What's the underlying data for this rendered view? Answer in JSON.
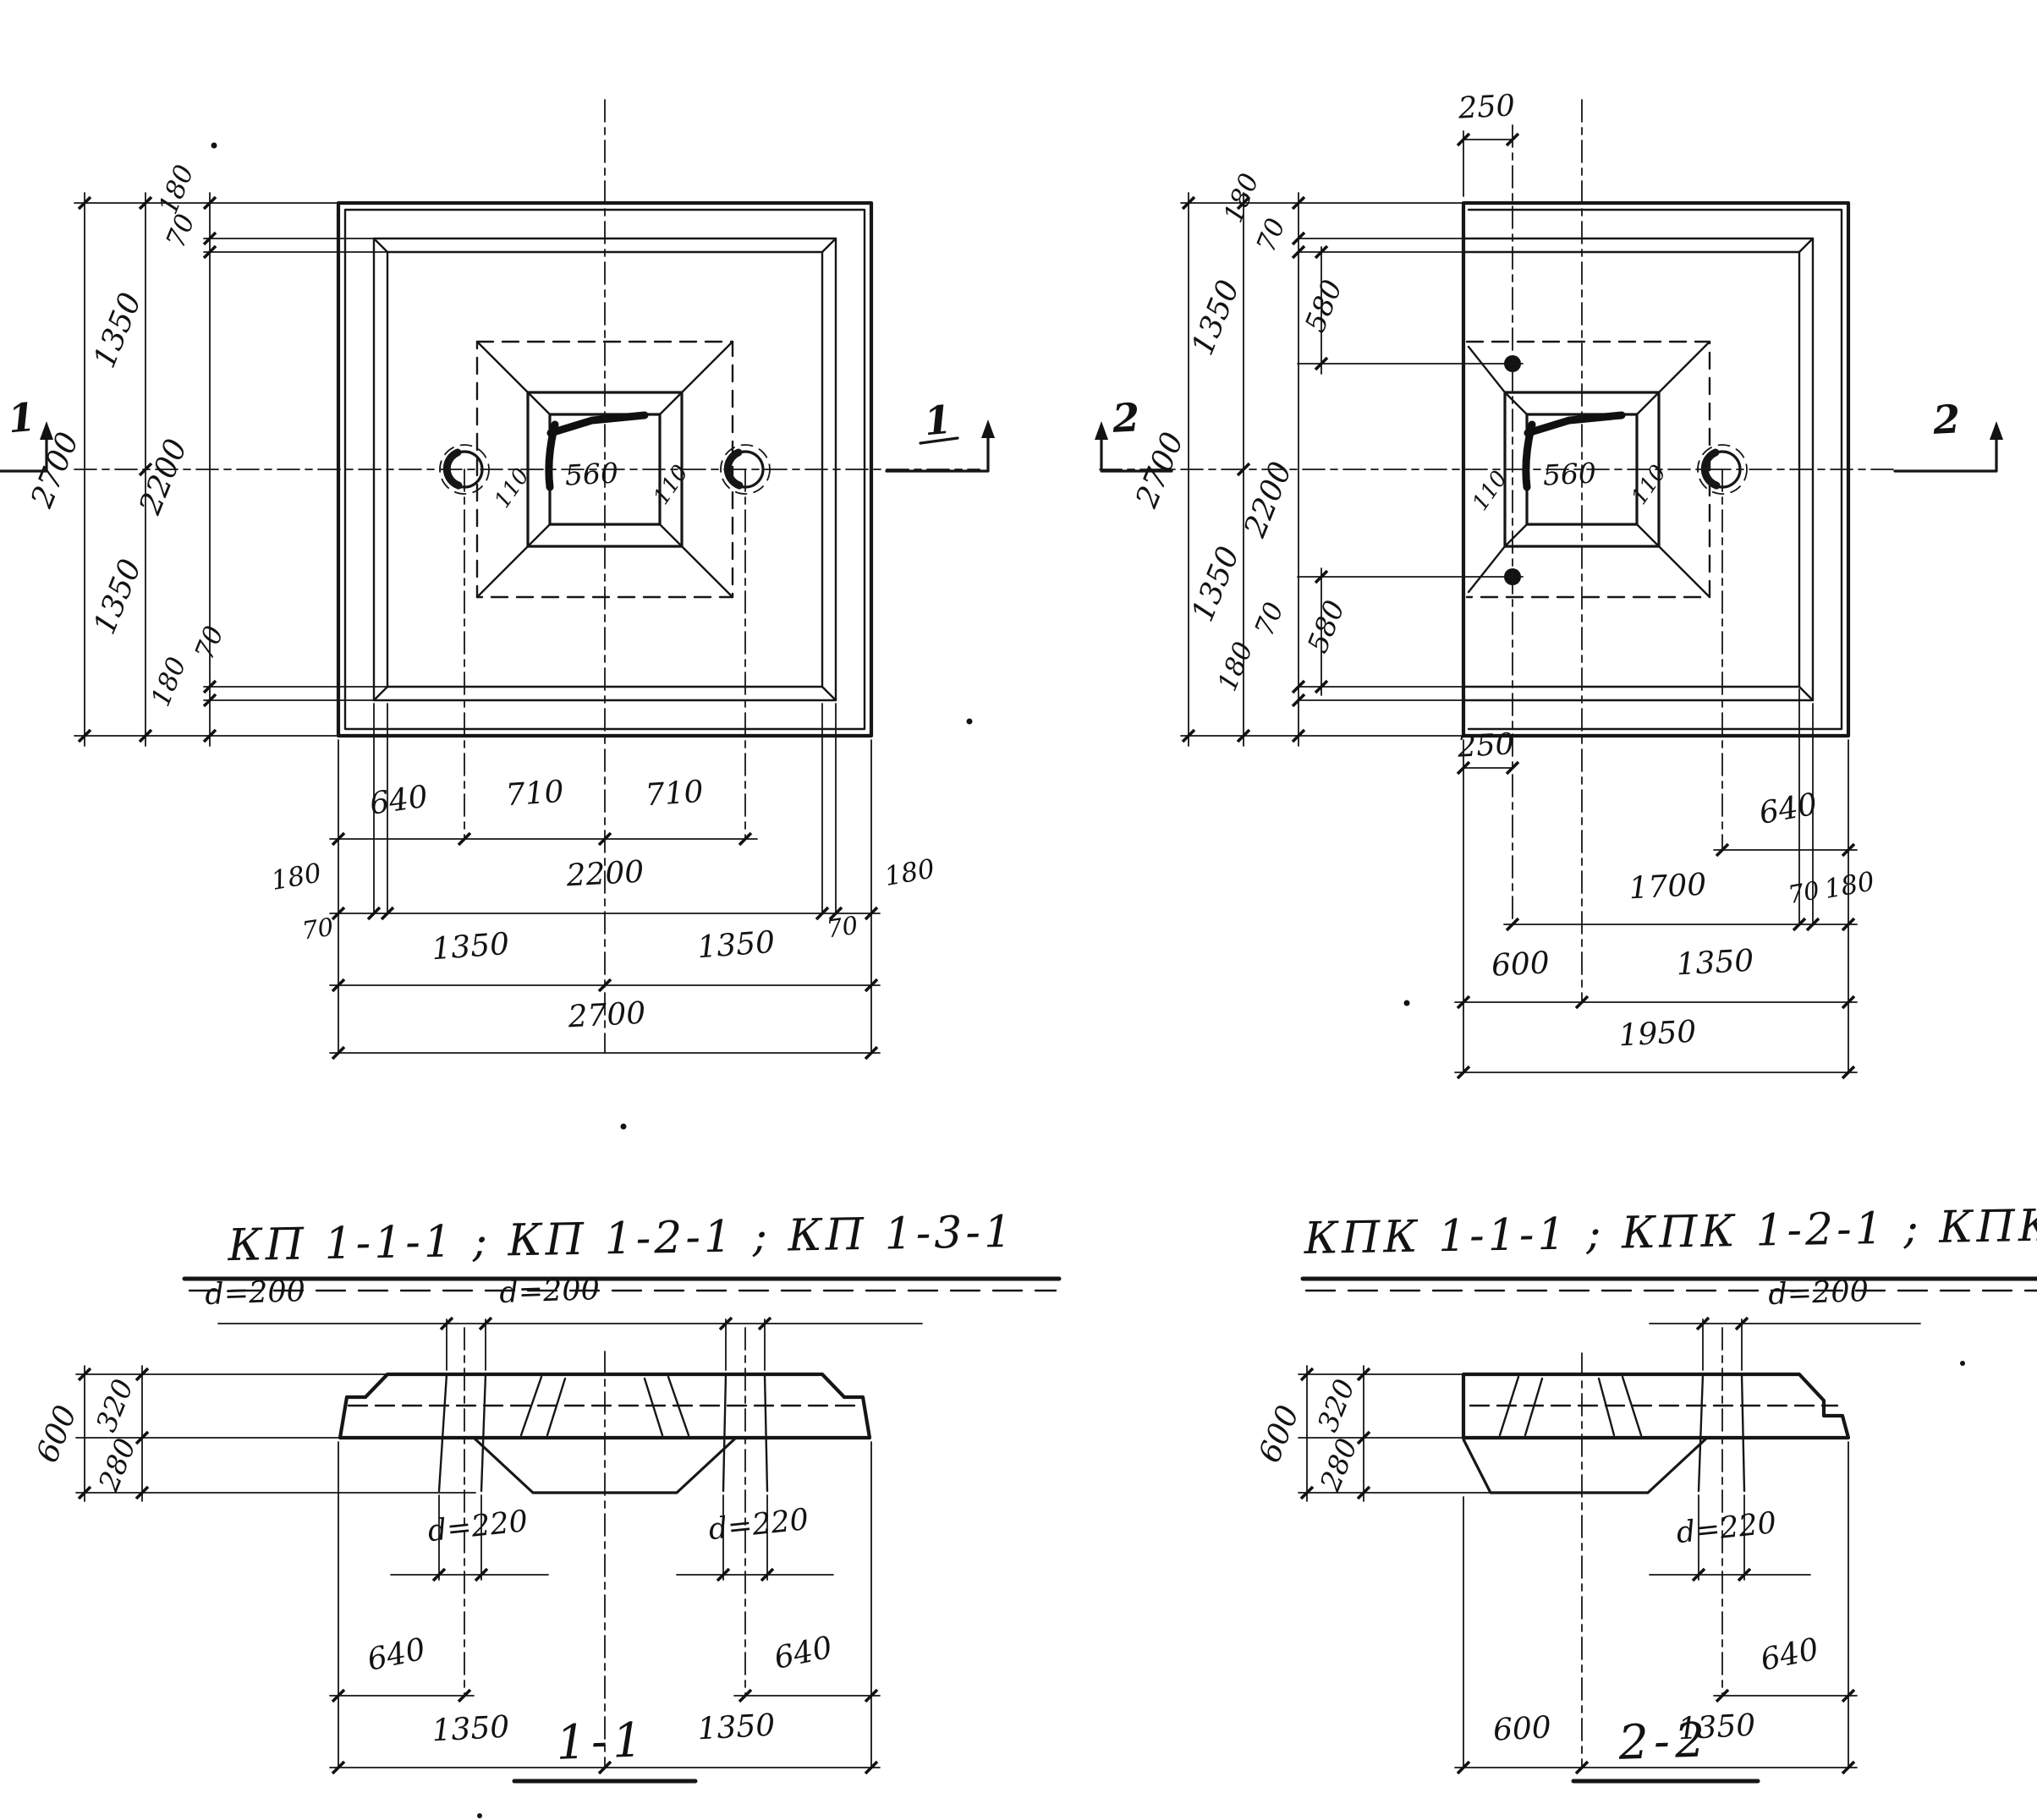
{
  "drawing": {
    "plan_kp": {
      "title": "КП 1-1-1 ; КП 1-2-1 ; КП 1-3-1",
      "section_marker": "1",
      "left": {
        "total": "2700",
        "half_top": "1350",
        "half_bottom": "1350",
        "edge_top": "180",
        "rib_top": "70",
        "inner": "2200",
        "rib_bottom": "70",
        "edge_bottom": "180"
      },
      "center": {
        "socket": "560",
        "wall_left": "110",
        "wall_right": "110"
      },
      "bottom": {
        "hole_offset": "640",
        "hole_span_left": "710",
        "hole_span_right": "710",
        "edge_left": "180",
        "inner": "2200",
        "edge_right": "180",
        "rib_left": "70",
        "rib_right": "70",
        "half_left": "1350",
        "half_right": "1350",
        "total": "2700"
      }
    },
    "plan_kpk": {
      "title": "КПК 1-1-1 ; КПК 1-2-1 ; КПК 1-3-1",
      "section_marker": "2",
      "top_hole_offset": "250",
      "bottom_hole_offset": "250",
      "left": {
        "total": "2700",
        "half_top": "1350",
        "half_bottom": "1350",
        "edge_top": "180",
        "rib_top": "70",
        "hole_top": "580",
        "inner": "2200",
        "hole_bottom": "580",
        "rib_bottom": "70",
        "edge_bottom": "180"
      },
      "center": {
        "socket": "560",
        "wall_left": "110",
        "wall_right": "110"
      },
      "bottom": {
        "hole_offset": "640",
        "span": "1700",
        "rib": "70",
        "edge": "180",
        "cut_left": "600",
        "half_right": "1350",
        "total": "1950"
      }
    },
    "section_1": {
      "title": "1-1",
      "hole_top_left": "d=200",
      "hole_top_right": "d=200",
      "hole_bottom_left": "d=220",
      "hole_bottom_right": "d=220",
      "offset_left": "640",
      "offset_right": "640",
      "half_left": "1350",
      "half_right": "1350",
      "height_total": "600",
      "height_top": "320",
      "height_bottom": "280"
    },
    "section_2": {
      "title": "2-2",
      "hole_top": "d=200",
      "hole_bottom": "d=220",
      "offset": "640",
      "cut_left": "600",
      "half_right": "1350",
      "height_total": "600",
      "height_top": "320",
      "height_bottom": "280"
    }
  }
}
